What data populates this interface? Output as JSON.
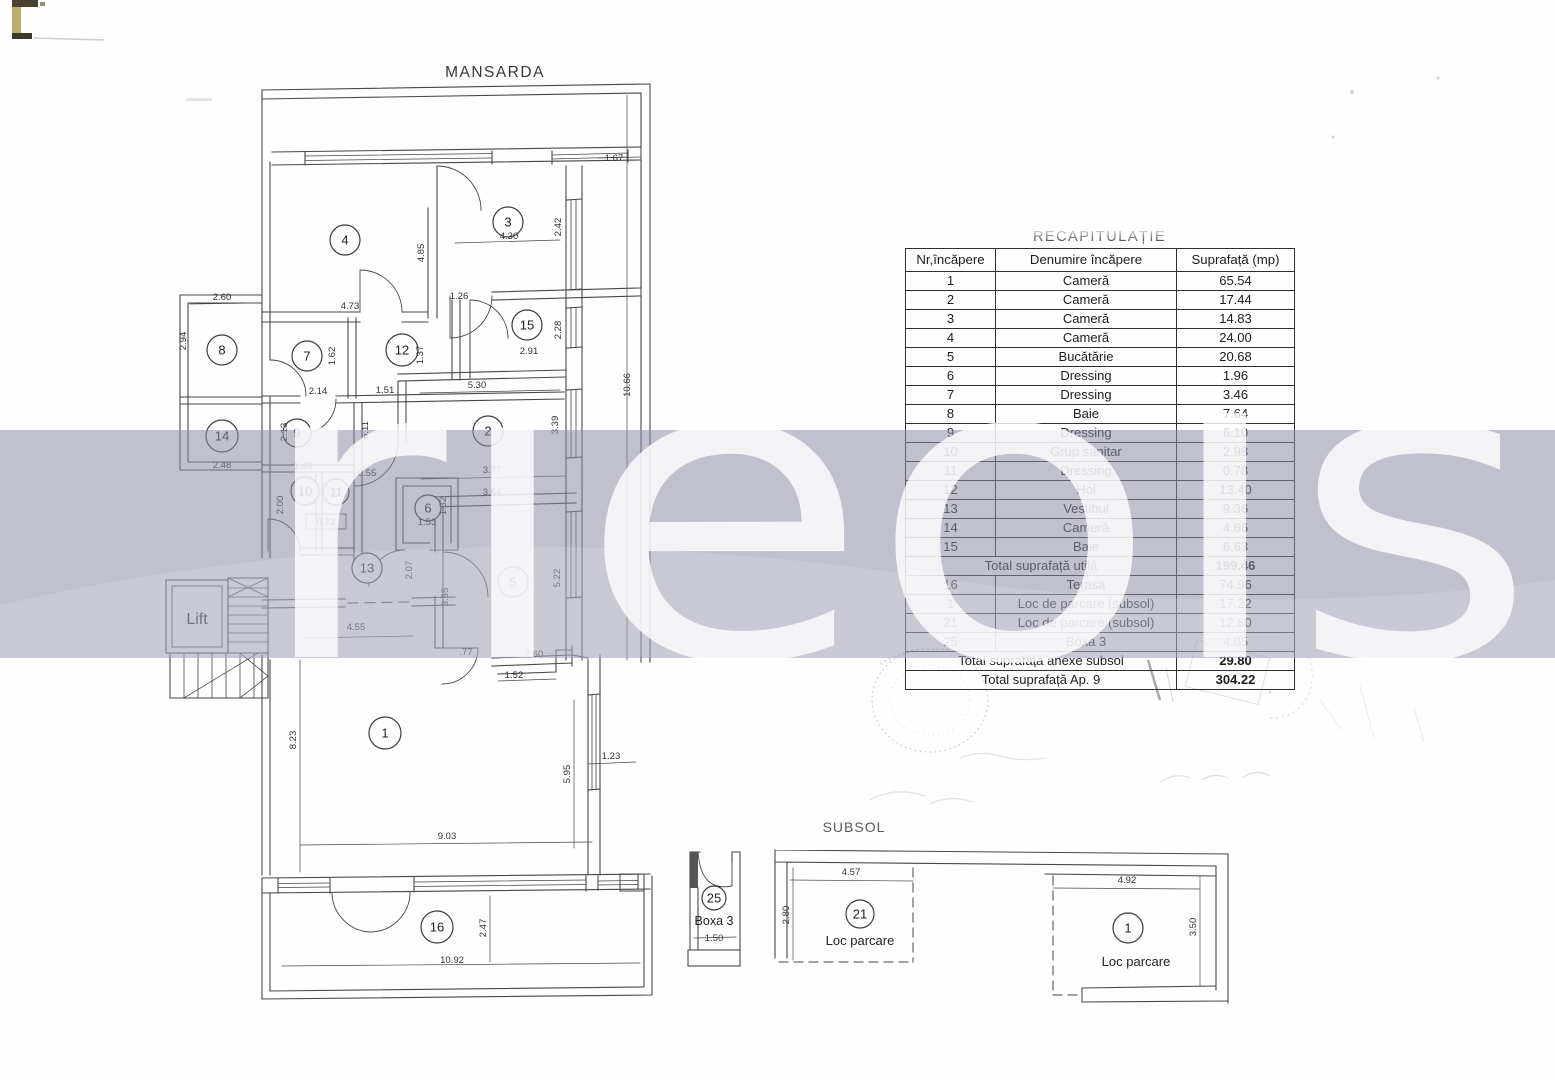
{
  "page": {
    "mansarda_title": "MANSARDA",
    "subsol_title": "SUBSOL"
  },
  "watermark": {
    "text": "rieols",
    "band_color": "#8c8ca8",
    "letter_color": "#ffffff"
  },
  "table": {
    "title": "RECAPITULAȚIE",
    "headers": [
      "Nr,încăpere",
      "Denumire încăpere",
      "Suprafață (mp)"
    ],
    "rows": [
      {
        "nr": "1",
        "name": "Cameră",
        "area": "65.54"
      },
      {
        "nr": "2",
        "name": "Cameră",
        "area": "17.44"
      },
      {
        "nr": "3",
        "name": "Cameră",
        "area": "14.83"
      },
      {
        "nr": "4",
        "name": "Cameră",
        "area": "24.00"
      },
      {
        "nr": "5",
        "name": "Bucătărie",
        "area": "20.68"
      },
      {
        "nr": "6",
        "name": "Dressing",
        "area": "1.96"
      },
      {
        "nr": "7",
        "name": "Dressing",
        "area": "3.46"
      },
      {
        "nr": "8",
        "name": "Baie",
        "area": "7.64"
      },
      {
        "nr": "9",
        "name": "Dressing",
        "area": "6.10"
      },
      {
        "nr": "10",
        "name": "Grup sanitar",
        "area": "2.98"
      },
      {
        "nr": "11",
        "name": "Dressing",
        "area": "0.78"
      },
      {
        "nr": "12",
        "name": "Hol",
        "area": "13.40"
      },
      {
        "nr": "13",
        "name": "Vestibul",
        "area": "9.36"
      },
      {
        "nr": "14",
        "name": "Cameră",
        "area": "4.66"
      },
      {
        "nr": "15",
        "name": "Baie",
        "area": "6.63"
      },
      {
        "total": true,
        "name": "Total suprafață utilă",
        "area": "199.46"
      },
      {
        "nr": "16",
        "name": "Terasa",
        "area": "74.96"
      },
      {
        "nr": "1",
        "name": "Loc de parcare (subsol)",
        "area": "17.22"
      },
      {
        "nr": "21",
        "name": "Loc de parcare (subsol)",
        "area": "12.80"
      },
      {
        "nr": "25",
        "name": "Boxa 3",
        "area": "4.05"
      },
      {
        "total": true,
        "name": "Total suprafață anexe subsol",
        "area": "29.80"
      },
      {
        "total": true,
        "name": "Total suprafață Ap. 9",
        "area": "304.22"
      }
    ]
  },
  "plan": {
    "labels": [
      {
        "t": "MANSARDA",
        "x": 495,
        "y": 77,
        "s": 15.5,
        "ls": 1.5,
        "c": "#383838"
      },
      {
        "t": "SUBSOL",
        "x": 854,
        "y": 832,
        "s": 14,
        "ls": 1,
        "c": "#5a5a5a"
      },
      {
        "t": "Lift",
        "x": 197,
        "y": 624,
        "s": 16,
        "ls": 0,
        "c": "#222222"
      },
      {
        "t": "Boxa 3",
        "x": 714,
        "y": 925,
        "s": 12.5,
        "ls": 0,
        "c": "#222222"
      },
      {
        "t": "Loc parcare",
        "x": 860,
        "y": 945,
        "s": 13,
        "ls": 0,
        "c": "#222222"
      },
      {
        "t": "Loc parcare",
        "x": 1136,
        "y": 966,
        "s": 13,
        "ls": 0,
        "c": "#222222"
      }
    ],
    "rooms": [
      {
        "n": "4",
        "x": 345,
        "y": 240,
        "r": 15
      },
      {
        "n": "3",
        "x": 508,
        "y": 222,
        "r": 15
      },
      {
        "n": "15",
        "x": 527,
        "y": 325,
        "r": 15
      },
      {
        "n": "8",
        "x": 222,
        "y": 350,
        "r": 15
      },
      {
        "n": "7",
        "x": 307,
        "y": 356,
        "r": 15
      },
      {
        "n": "12",
        "x": 402,
        "y": 350,
        "r": 16
      },
      {
        "n": "14",
        "x": 222,
        "y": 436,
        "r": 16
      },
      {
        "n": "9",
        "x": 297,
        "y": 433,
        "r": 14
      },
      {
        "n": "2",
        "x": 488,
        "y": 431,
        "r": 15
      },
      {
        "n": "10",
        "x": 305,
        "y": 491,
        "r": 14
      },
      {
        "n": "11",
        "x": 336,
        "y": 492,
        "r": 13
      },
      {
        "n": "6",
        "x": 428,
        "y": 508,
        "r": 13
      },
      {
        "n": "13",
        "x": 367,
        "y": 568,
        "r": 15
      },
      {
        "n": "5",
        "x": 513,
        "y": 582,
        "r": 15
      },
      {
        "n": "1",
        "x": 385,
        "y": 733,
        "r": 16
      },
      {
        "n": "16",
        "x": 437,
        "y": 927,
        "r": 16
      },
      {
        "n": "25",
        "x": 714,
        "y": 898,
        "r": 12
      },
      {
        "n": "21",
        "x": 860,
        "y": 914,
        "r": 14
      },
      {
        "n": "1",
        "x": 1128,
        "y": 928,
        "r": 15
      }
    ],
    "dims": [
      {
        "v": "1.67",
        "x": 614,
        "y": 161,
        "r": 0
      },
      {
        "v": "4.85",
        "x": 424,
        "y": 253,
        "r": -90
      },
      {
        "v": "4.30",
        "x": 509,
        "y": 239,
        "r": 0
      },
      {
        "v": "2.42",
        "x": 561,
        "y": 227,
        "r": -90
      },
      {
        "v": "1.26",
        "x": 459,
        "y": 299,
        "r": 0
      },
      {
        "v": "4.73",
        "x": 350,
        "y": 309,
        "r": 0
      },
      {
        "v": "2.60",
        "x": 222,
        "y": 300,
        "r": 0
      },
      {
        "v": "2.94",
        "x": 186,
        "y": 341,
        "r": -90
      },
      {
        "v": "1.62",
        "x": 335,
        "y": 356,
        "r": -90
      },
      {
        "v": "1.37",
        "x": 423,
        "y": 355,
        "r": -90
      },
      {
        "v": "2.91",
        "x": 529,
        "y": 354,
        "r": 0
      },
      {
        "v": "2.28",
        "x": 561,
        "y": 330,
        "r": -90
      },
      {
        "v": "5.30",
        "x": 477,
        "y": 388,
        "r": 0
      },
      {
        "v": "10.66",
        "x": 630,
        "y": 385,
        "r": -90
      },
      {
        "v": "3.39",
        "x": 558,
        "y": 425,
        "r": -90
      },
      {
        "v": "2.14",
        "x": 318,
        "y": 394,
        "r": 0
      },
      {
        "v": "1.51",
        "x": 385,
        "y": 393,
        "r": 0
      },
      {
        "v": "6.11",
        "x": 368,
        "y": 430,
        "r": -90
      },
      {
        "v": "2.13",
        "x": 287,
        "y": 432,
        "r": -90
      },
      {
        "v": "2.48",
        "x": 222,
        "y": 468,
        "r": 0
      },
      {
        "v": "1.49",
        "x": 303,
        "y": 469,
        "r": 0
      },
      {
        "v": "0.55",
        "x": 367,
        "y": 476,
        "r": 0
      },
      {
        "v": "2.00",
        "x": 283,
        "y": 505,
        "r": -90
      },
      {
        "v": "0.73",
        "x": 326,
        "y": 525,
        "r": 0
      },
      {
        "v": "1.32",
        "x": 446,
        "y": 506,
        "r": -90
      },
      {
        "v": "1.53",
        "x": 427,
        "y": 525,
        "r": 0
      },
      {
        "v": "3.77",
        "x": 492,
        "y": 473,
        "r": 0
      },
      {
        "v": "3.64",
        "x": 492,
        "y": 495,
        "r": 0
      },
      {
        "v": "2.07",
        "x": 412,
        "y": 570,
        "r": -90
      },
      {
        "v": "3.35",
        "x": 448,
        "y": 597,
        "r": -90
      },
      {
        "v": "5.22",
        "x": 560,
        "y": 578,
        "r": -90
      },
      {
        "v": "4.55",
        "x": 356,
        "y": 630,
        "r": 0
      },
      {
        "v": ".77",
        "x": 466,
        "y": 655,
        "r": 0
      },
      {
        "v": "2.60",
        "x": 534,
        "y": 657,
        "r": 0
      },
      {
        "v": "1.52",
        "x": 514,
        "y": 678,
        "r": 0
      },
      {
        "v": "8.23",
        "x": 296,
        "y": 740,
        "r": -90
      },
      {
        "v": "5.95",
        "x": 570,
        "y": 774,
        "r": -90
      },
      {
        "v": "1.23",
        "x": 611,
        "y": 759,
        "r": 0
      },
      {
        "v": "9.03",
        "x": 447,
        "y": 839,
        "r": 0
      },
      {
        "v": "2.47",
        "x": 486,
        "y": 928,
        "r": -90
      },
      {
        "v": "10.92",
        "x": 452,
        "y": 963,
        "r": 0
      },
      {
        "v": "1.50",
        "x": 714,
        "y": 941,
        "r": 0
      },
      {
        "v": "4.57",
        "x": 851,
        "y": 875,
        "r": 0
      },
      {
        "v": "2.80",
        "x": 789,
        "y": 915,
        "r": -90
      },
      {
        "v": "4.92",
        "x": 1127,
        "y": 883,
        "r": 0
      },
      {
        "v": "3.50",
        "x": 1196,
        "y": 927,
        "r": -90
      }
    ]
  }
}
